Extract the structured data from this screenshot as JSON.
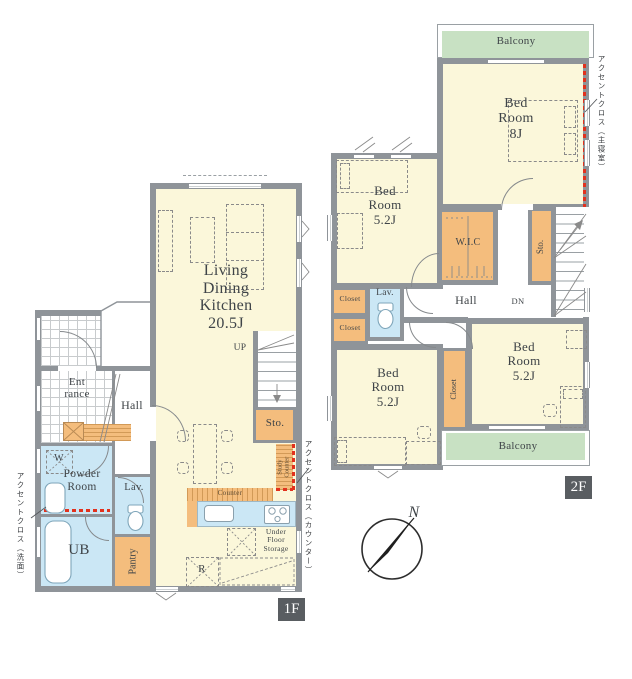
{
  "title": "floor-plan",
  "colors": {
    "room_yellow": "#FBF7DA",
    "balcony_green": "#C8E1C3",
    "fixture_orange": "#F4BD7D",
    "water_blue": "#CBE7F5",
    "wall_gray": "#8F9499",
    "accent_red": "#E2311D",
    "floor_label_bg": "#595D61"
  },
  "floor1": {
    "label": "1F",
    "rooms": {
      "ldk": "Living\nDining\nKitchen\n20.5J",
      "entrance": "Ent\nrance",
      "hall": "Hall",
      "powder_room": "Powder\nRoom",
      "washer": "W",
      "lavatory": "Lav.",
      "unit_bath": "UB",
      "pantry": "Pantry",
      "storage": "Sto.",
      "stairs_up": "UP",
      "counter": "Counter",
      "study_counter": "Study\nCounter",
      "under_floor_storage": "Under\nFloor\nStorage",
      "refrigerator": "R"
    },
    "annotations": {
      "accent_washroom": "アクセントクロス（洗面）",
      "accent_counter": "アクセントクロス（カウンター）"
    }
  },
  "floor2": {
    "label": "2F",
    "rooms": {
      "balcony": "Balcony",
      "bedroom_8": "Bed\nRoom\n8J",
      "bedroom_52": "Bed\nRoom\n5.2J",
      "wic": "W.I.C",
      "storage": "Sto.",
      "hall": "Hall",
      "stairs_down": "DN",
      "lavatory": "Lav.",
      "closet": "Closet"
    },
    "annotations": {
      "accent_master": "アクセントクロス（主寝室）"
    }
  },
  "compass": {
    "north": "N"
  }
}
